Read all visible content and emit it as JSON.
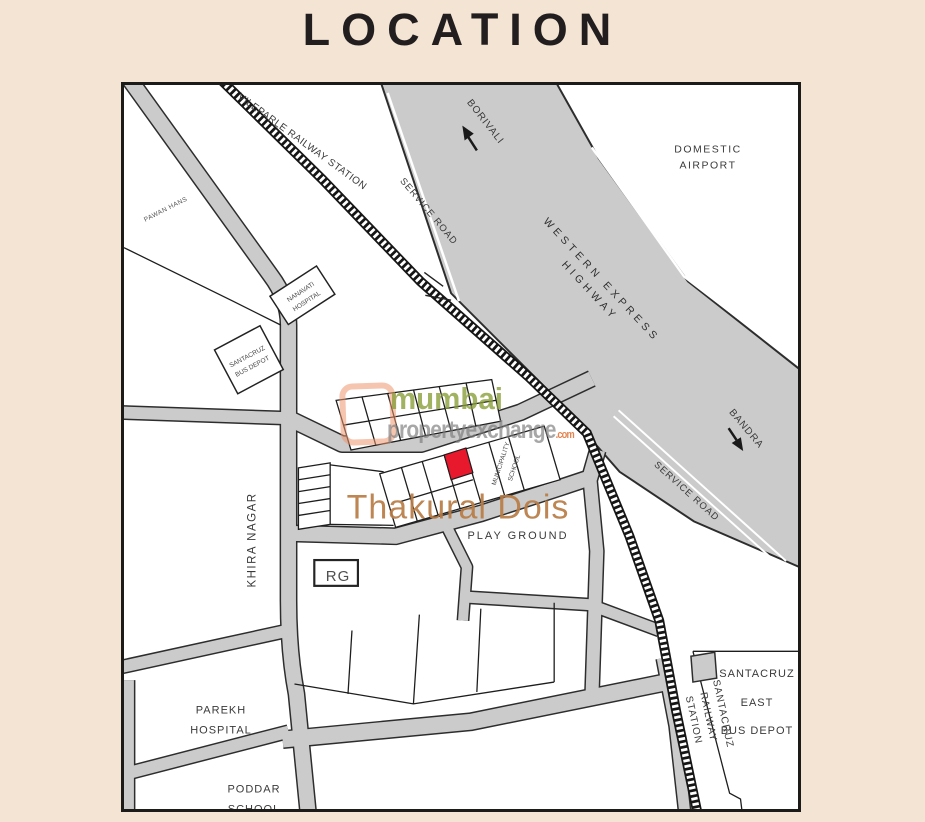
{
  "page": {
    "title": "LOCATION"
  },
  "colors": {
    "background": "#f3e4d3",
    "map_border": "#1d1b1a",
    "road_fill": "#cbcbcb",
    "road_casing": "#2d2d2d",
    "highlight_red": "#e8192c",
    "project_text": "#b87c45",
    "watermark_green": "#869c34",
    "watermark_gray": "#8f8f8f",
    "watermark_orange": "#e0763c"
  },
  "map": {
    "labels": {
      "vileparle_railway_station": "VILEPARLE RAILWAY STATION",
      "service_road_west": "SERVICE ROAD",
      "service_road_east": "SERVICE ROAD",
      "borivali": "BORIVALI",
      "domestic_airport": "DOMESTIC AIRPORT",
      "western_express_highway": "WESTERN EXPRESS HIGHWAY",
      "bandra": "BANDRA",
      "pawan_hans": "PAWAN HANS",
      "nanavati_hospital": "NANAVATI\nHOSPITAL",
      "santacruz_bus_depot": "SANTACRUZ\nBUS DEPOT",
      "khira_nagar": "KHIRA NAGAR",
      "municipality_school": "MUNICIPALITY\nSCHOOL",
      "rg": "RG",
      "project_name": "Thakural Dois",
      "play_ground": "PLAY GROUND",
      "parekh_hospital": "PAREKH\nHOSPITAL",
      "poddar_school": "PODDAR\nSCHOOL",
      "santacruz_railway_station": "SANTACRUZ RAILWAY STATION",
      "santacruz_east_bus_depot": "SANTACRUZ\nEAST\nBUS DEPOT"
    },
    "icons": {
      "borivali_arrow": "arrow-up-northwest",
      "bandra_arrow": "arrow-down-southeast"
    },
    "watermark": {
      "line1": "mumbai",
      "line2": "propertyexchange",
      "tld": ".com"
    }
  }
}
